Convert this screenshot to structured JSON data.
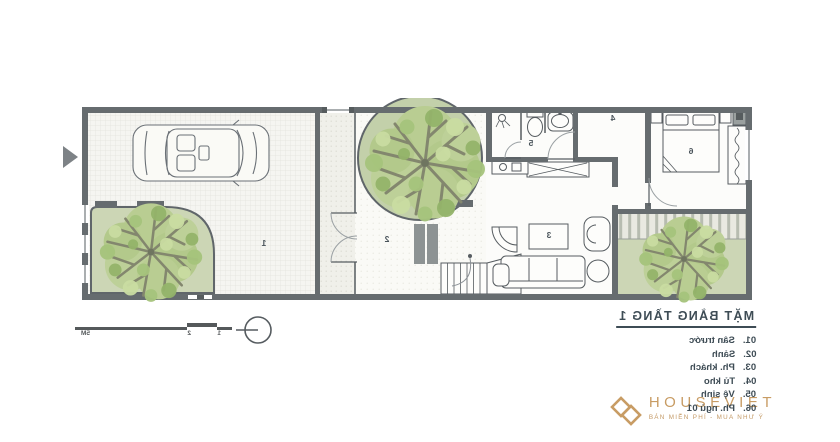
{
  "plan": {
    "room_numbers": {
      "r1": "1",
      "r2": "2",
      "r3": "3",
      "r4": "4",
      "r5": "5",
      "r6": "6"
    }
  },
  "annotations": {
    "title": "MẶT BẰNG TẦNG 1",
    "legend": [
      {
        "no": "01.",
        "label": "Sân trước"
      },
      {
        "no": "02.",
        "label": "Sảnh"
      },
      {
        "no": "03.",
        "label": "Ph. khách"
      },
      {
        "no": "04.",
        "label": "Tủ kho"
      },
      {
        "no": "05.",
        "label": "Vệ sinh"
      },
      {
        "no": "06.",
        "label": "Ph. ngủ 01"
      }
    ],
    "scale_labels": [
      "1",
      "2",
      "5M"
    ]
  },
  "logo": {
    "name": "HOUSEVIET",
    "tagline": "BÁN MIỄN PHÍ - MUA NHƯ Ý"
  },
  "colors": {
    "wall": "#666c6f",
    "accent": "#c89c64",
    "text": "#3e4c55",
    "green": "#cbd6b4"
  }
}
